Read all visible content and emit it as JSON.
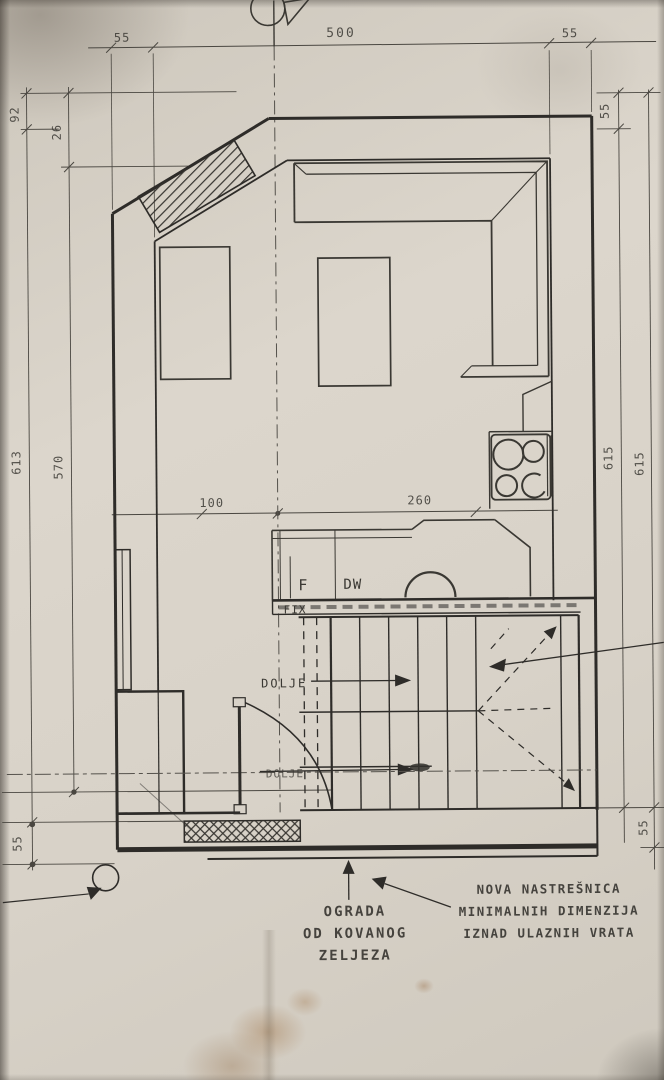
{
  "document": {
    "type": "Hand-drawn architectural floor plan (photograph of pencil drawing)"
  },
  "colors": {
    "paper": "#d7d1c7",
    "ink": "#2e2c29",
    "dim_ink": "#4a4741",
    "stain": "#9a7a4a"
  },
  "dimensions": {
    "top_left_wall": "55",
    "top_span": "500",
    "top_right_wall": "55",
    "upper_left_outer": "92",
    "upper_left_inner": "26",
    "left_total": "613",
    "left_inner_total": "570",
    "bottom_left": "55",
    "right_wall_top": "55",
    "right_total_outer": "615",
    "right_total_inner": "615",
    "bottom_right": "55",
    "kitchen_left": "100",
    "kitchen_right": "260"
  },
  "room_labels": {
    "fridge": "F",
    "dishwasher": "DW",
    "fixed_glazing": "FIX",
    "stairs_down_upper": "DOLJE",
    "stairs_down_lower": "DOLJE"
  },
  "annotations": {
    "fence_line1": "OGRADA",
    "fence_line2": "OD KOVANOG",
    "fence_line3": "ZELJEZA",
    "canopy_line1": "NOVA NASTREŠNICA",
    "canopy_line2": "MINIMALNIH DIMENZIJA",
    "canopy_line3": "IZNAD ULAZNIH VRATA"
  }
}
